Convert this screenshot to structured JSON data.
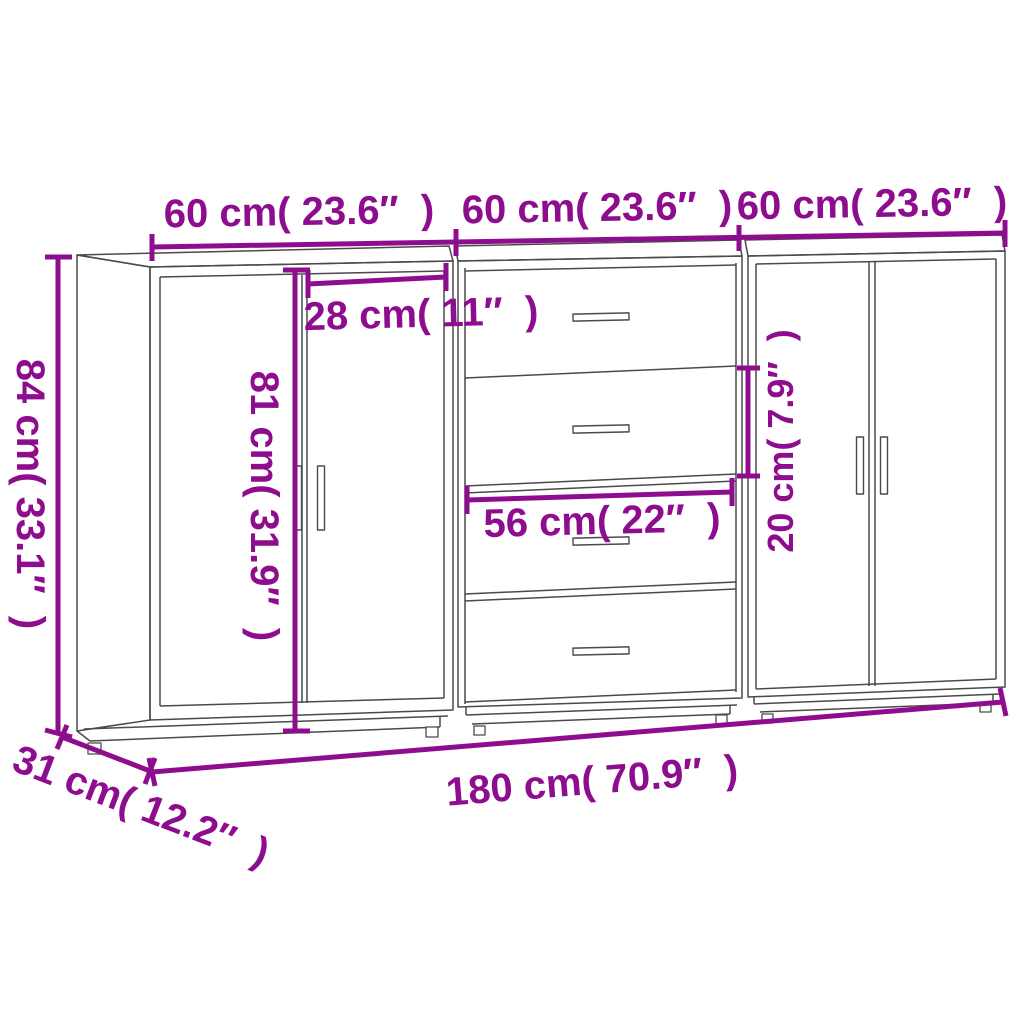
{
  "colors": {
    "dimension": "#8E0D8E",
    "wireframe": "#4a4a4a",
    "bg": "#ffffff"
  },
  "labels": {
    "width_left": "60 cm( 23.6″  )",
    "width_middle": "60 cm( 23.6″  )",
    "width_right": "60 cm( 23.6″  )",
    "height": "84 cm( 33.1″  )",
    "door_height": "81 cm( 31.9″  )",
    "door_width": "28 cm( 11″  )",
    "drawer_width": "56 cm( 22″  )",
    "drawer_height": "20 cm( 7.9″  )",
    "total_width": "180 cm( 70.9″  )",
    "depth": "31 cm( 12.2″  )"
  }
}
